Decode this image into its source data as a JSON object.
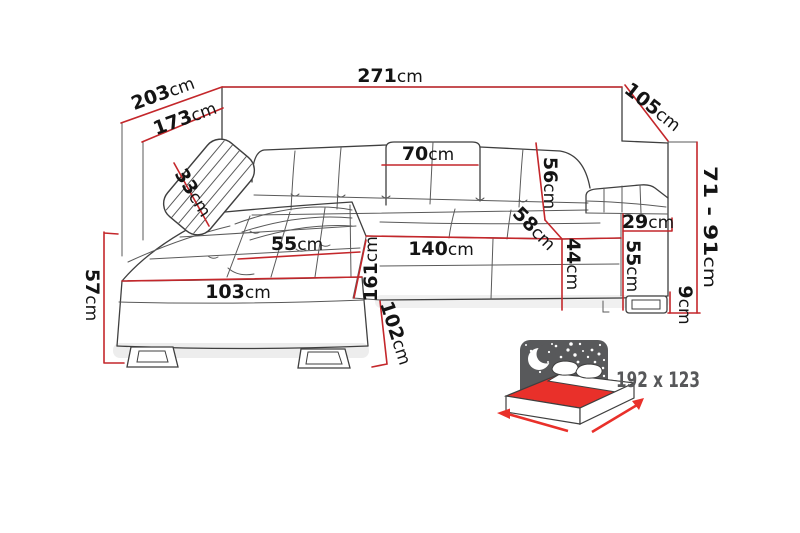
{
  "dimensions": {
    "back_width": {
      "value": "271",
      "unit": "cm"
    },
    "chaise_outer_depth": {
      "value": "203",
      "unit": "cm"
    },
    "chaise_inner_depth": {
      "value": "173",
      "unit": "cm"
    },
    "right_side_depth": {
      "value": "105",
      "unit": "cm"
    },
    "headrest_cushion_width": {
      "value": "70",
      "unit": "cm"
    },
    "pillow_width": {
      "value": "33",
      "unit": "cm"
    },
    "backrest_height": {
      "value": "56",
      "unit": "cm"
    },
    "seat_depth": {
      "value": "58",
      "unit": "cm"
    },
    "seat_width": {
      "value": "140",
      "unit": "cm"
    },
    "chaise_seat_width": {
      "value": "55",
      "unit": "cm"
    },
    "chaise_front_width": {
      "value": "103",
      "unit": "cm"
    },
    "chaise_length": {
      "value": "161",
      "unit": "cm"
    },
    "seat_height": {
      "value": "57",
      "unit": "cm"
    },
    "chaise_side_height": {
      "value": "102",
      "unit": "cm"
    },
    "seat_front_height": {
      "value": "44",
      "unit": "cm"
    },
    "arm_height": {
      "value": "55",
      "unit": "cm"
    },
    "arm_width": {
      "value": "29",
      "unit": "cm"
    },
    "total_height_range": {
      "value": "71 - 91",
      "unit": "cm"
    },
    "leg_height": {
      "value": "9",
      "unit": "cm"
    }
  },
  "sleeping_area": {
    "size_label": "192 x 123"
  },
  "colors": {
    "dimension_line_red": "#c4272b",
    "sleeping_area_red": "#e9302a",
    "icon_gray": "#58595b",
    "sketch_line_gray": "#3f3f3f"
  }
}
